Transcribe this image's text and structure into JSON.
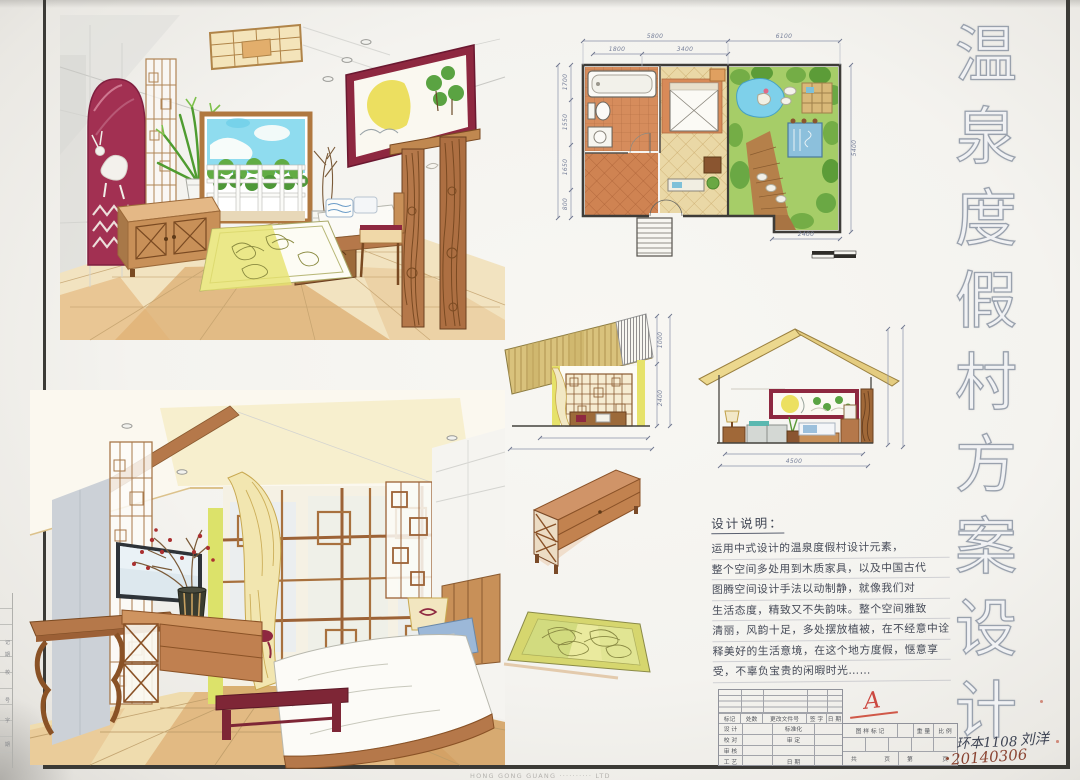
{
  "board": {
    "title": "温泉度假村方案设计",
    "watermark": "HONG GONG GUANG ·········· LTD"
  },
  "calligraphy": {
    "chars": [
      "温",
      "泉",
      "度",
      "假",
      "村",
      "方",
      "案",
      "设",
      "计"
    ]
  },
  "floor_plan": {
    "dim_top_left": "5800",
    "dim_top_right": "6100",
    "dim_inner_left": "1800",
    "dim_inner_right": "3400",
    "dims_left": [
      "1700",
      "1550",
      "1650",
      "800"
    ],
    "dim_right": "5400",
    "dim_bottom": "2400"
  },
  "elevations": {
    "left": {
      "dim_upper": "1000",
      "dim_lower": "2400"
    },
    "right": {
      "dim_bottom": "4500"
    }
  },
  "notes": {
    "title": "设计说明：",
    "lines": [
      "运用中式设计的温泉度假村设计元素，",
      "整个空间多处用到木质家具，以及中国古代",
      "图腾空间设计手法以动制静，就像我们对",
      "生活态度，精致又不失韵味。整个空间雅致",
      "清丽，风韵十足，多处摆放植被，在不经意中诠",
      "释美好的生活意境，在这个地方度假，惬意享",
      "受，不辜负宝贵的闲暇时光……"
    ]
  },
  "title_block": {
    "rev_header": [
      "标记",
      "处数",
      "更改文件号",
      "签 字",
      "日 期"
    ],
    "left_rows": [
      {
        "label": "设 计",
        "mid": "标准化"
      },
      {
        "label": "校 对",
        "mid": "审 定"
      },
      {
        "label": "审 核",
        "mid": ""
      },
      {
        "label": "工 艺",
        "mid": "日 期"
      }
    ],
    "mark_label": "图 样 标 记",
    "weight_label": "重 量",
    "scale_label": "比 例",
    "total_label": "共",
    "page_label": "页",
    "sheet_label": "第",
    "page2_label": "页",
    "red_mark": "A",
    "class_no": "环本1108",
    "author": "刘洋",
    "date": "20140306"
  },
  "left_strip": {
    "cells": [
      "记",
      "期",
      "校",
      "号",
      "字",
      "期"
    ]
  }
}
